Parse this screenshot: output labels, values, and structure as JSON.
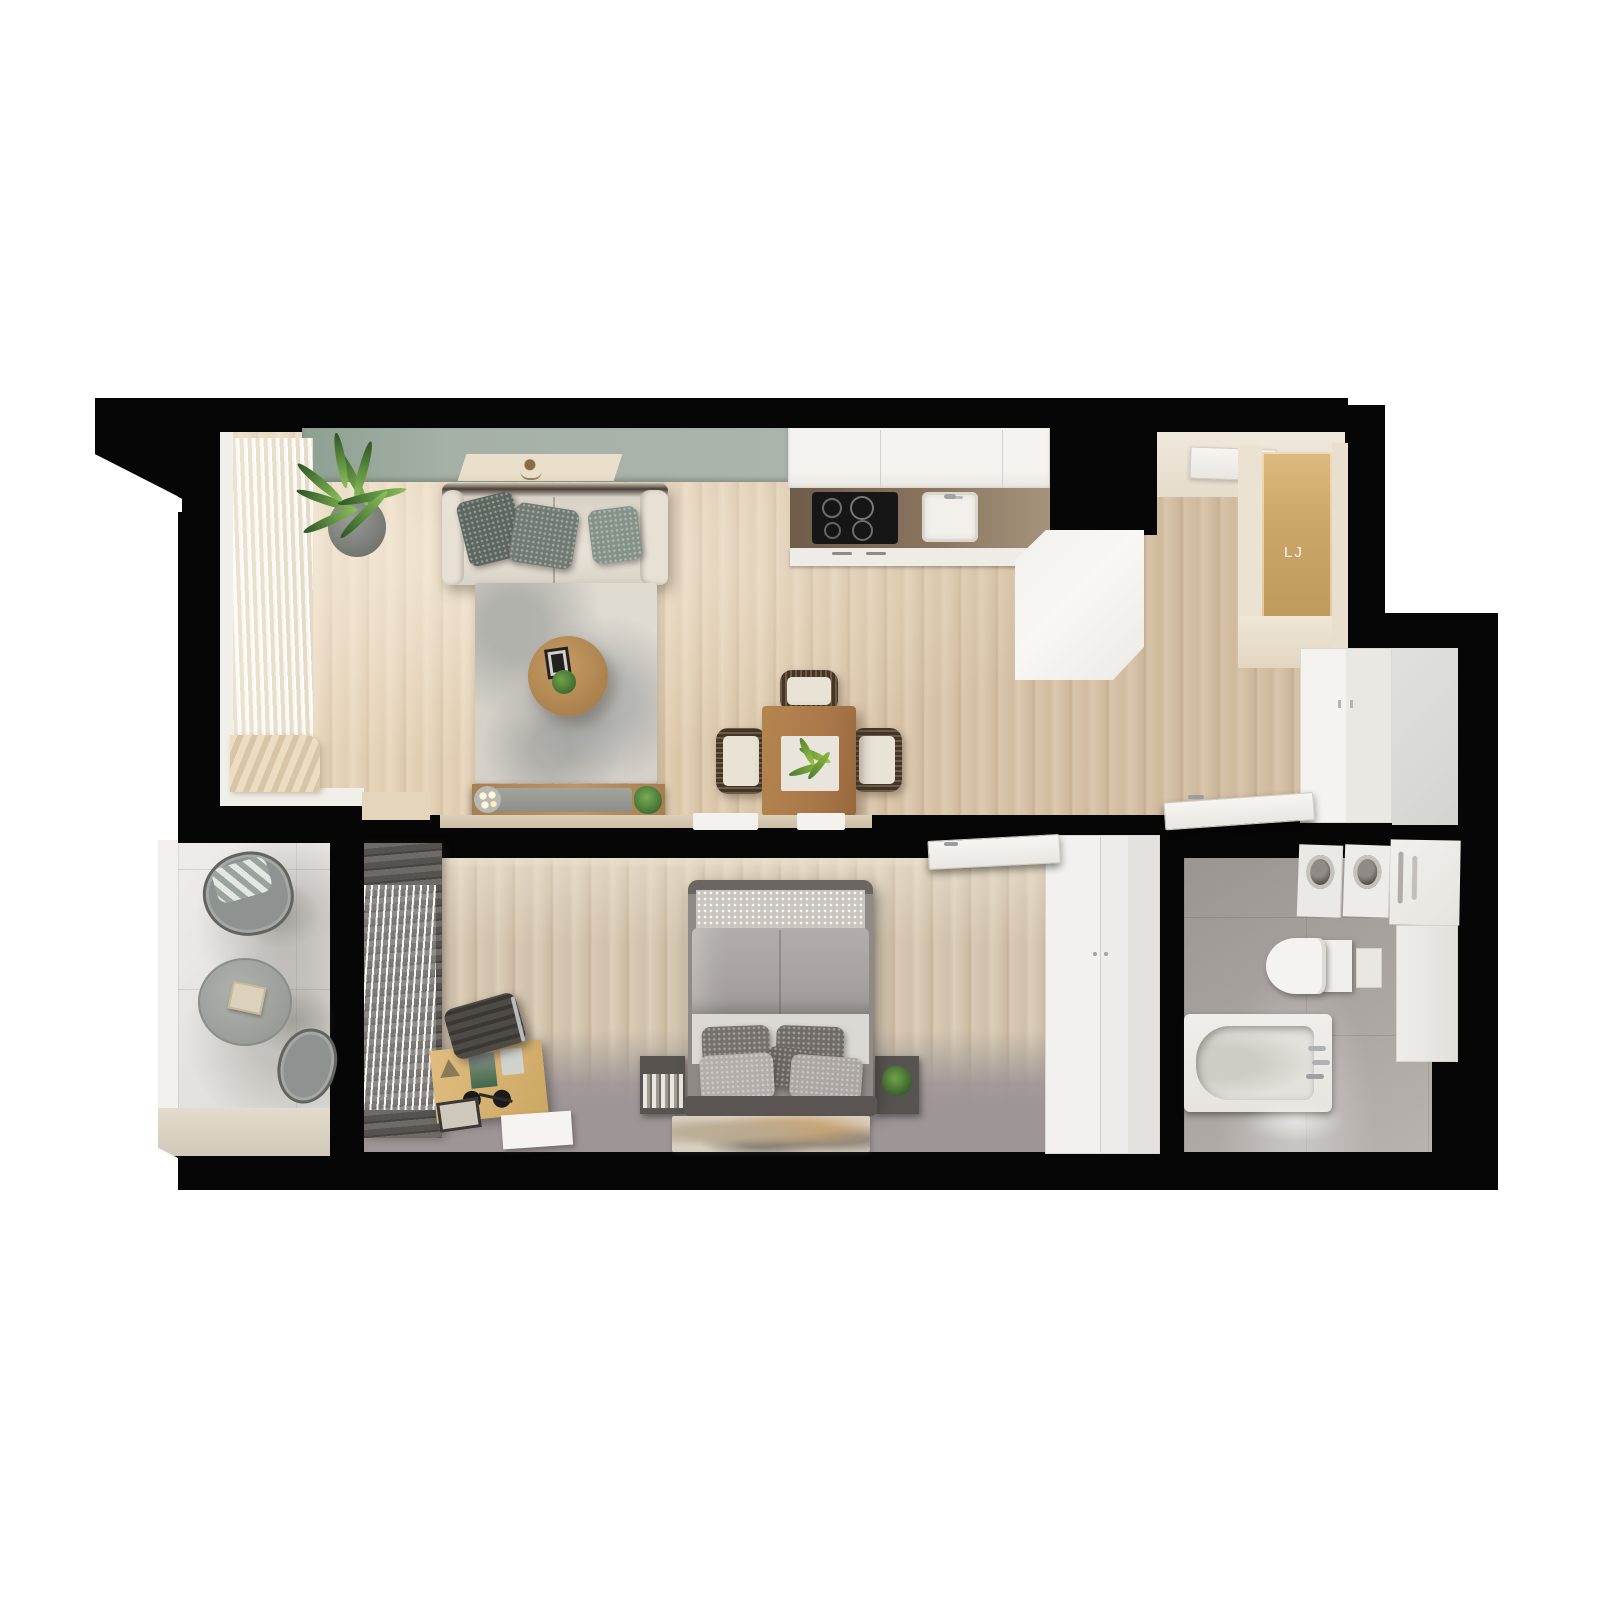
{
  "scene": {
    "kind": "3d-rendered-apartment-floor-plan-top-view",
    "decals": {
      "hall_mirror_monogram": "LJ"
    },
    "palette": {
      "wall": "#060606",
      "background": "#ffffff",
      "wood_floor": "#dcc8ac",
      "bedroom_wood": "#d3c6b0",
      "bedroom_carpet": "#9d9596",
      "accent_green_wall": "#a3aea4",
      "living_rug": "#d2cdc5",
      "sofa": "#e2dcd1",
      "kitchen_counter": "#7b6853",
      "cooktop": "#161616",
      "balcony_marble": "#e8e6e2",
      "bathroom_tile": "#a8a29e",
      "furniture_wood": "#b5854f",
      "plant_green": "#5d924a",
      "curtain_dark": "#5f5b57",
      "hall_cream": "#ece2d2",
      "hall_wood_panel": "#c9a76b"
    },
    "rooms": [
      {
        "name": "living-room",
        "furniture": [
          "sofa",
          "throw-pillows",
          "area-rug",
          "round-coffee-table",
          "media-console",
          "candles",
          "potted-plant",
          "dining-table",
          "dining-chairs",
          "sheer-curtains",
          "sage-accent-wall",
          "ceiling-light-panel"
        ]
      },
      {
        "name": "kitchen",
        "furniture": [
          "upper-cabinets",
          "countertop",
          "cooktop",
          "sink",
          "tall-cabinet-fridge"
        ]
      },
      {
        "name": "entry-hall",
        "furniture": [
          "entry-door",
          "wood-mirror-panel",
          "cream-wardrobe",
          "closet-doors"
        ]
      },
      {
        "name": "bedroom",
        "furniture": [
          "double-bed",
          "pillows",
          "patterned-throw",
          "nightstand-books",
          "nightstand-plant",
          "abstract-rug",
          "desk",
          "office-chair",
          "notebook",
          "picture-frame",
          "wardrobe",
          "dark-curtains",
          "door-leaf"
        ]
      },
      {
        "name": "bathroom",
        "furniture": [
          "bathtub",
          "faucet",
          "wall-hung-toilet",
          "washer",
          "dryer",
          "storage-cabinet"
        ]
      },
      {
        "name": "balcony",
        "furniture": [
          "wire-lounge-chair",
          "striped-cushion",
          "round-bistro-table",
          "book",
          "second-chair"
        ]
      }
    ]
  }
}
